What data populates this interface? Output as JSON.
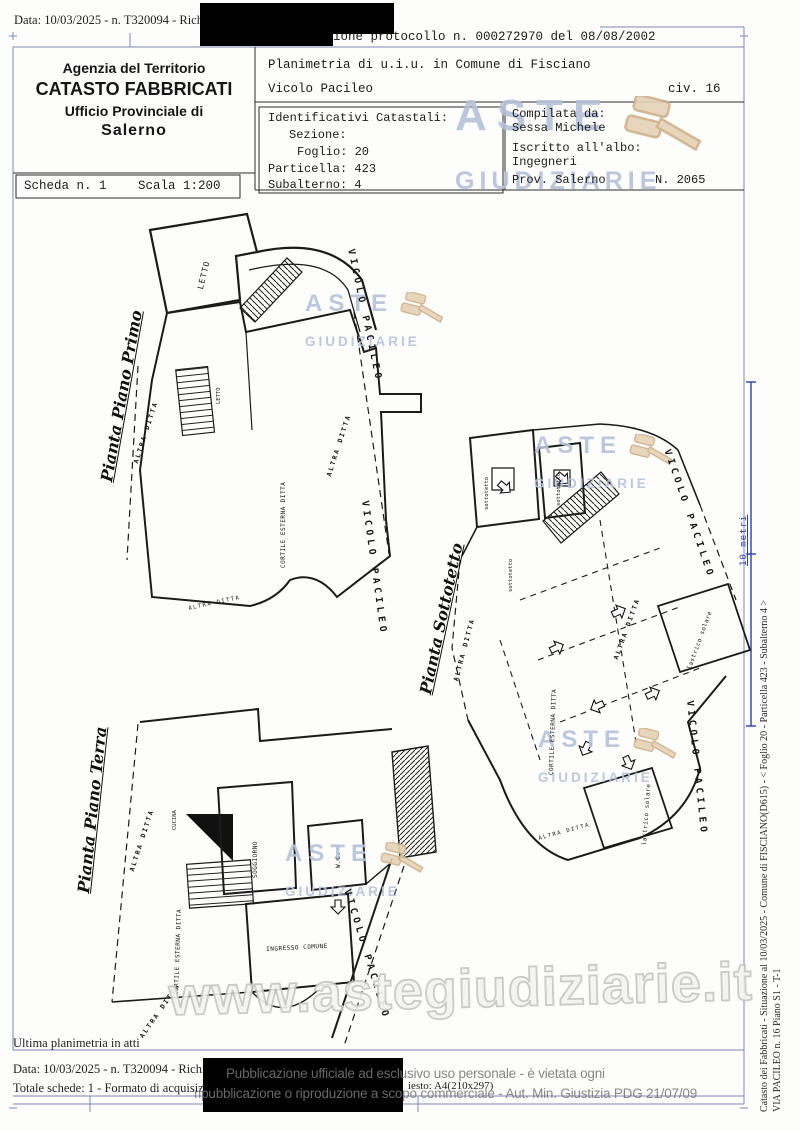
{
  "top": {
    "data_line": "Data: 10/03/2025 - n. T320094 - Richiedent",
    "protocol_line": "ione protocollo n. 000272970 del 08/08/2002"
  },
  "header": {
    "agency_line1": "Agenzia del Territorio",
    "agency_line2": "CATASTO FABBRICATI",
    "agency_line3": "Ufficio Provinciale di",
    "agency_line4": "Salerno",
    "planimetria_line": "Planimetria di u.i.u. in Comune di Fisciano",
    "street_name": "Vicolo Pacileo",
    "civic": "civ. 16",
    "identificativi": {
      "title": "Identificativi Catastali:",
      "sezione": "Sezione:",
      "foglio": "Foglio: 20",
      "particella": "Particella: 423",
      "subalterno": "Subalterno: 4"
    },
    "compilata": {
      "label": "Compilata da:",
      "name": "Sessa Michele",
      "albo_label": "Iscritto all'albo:",
      "albo_value": "Ingegneri",
      "prov": "Prov. Salerno",
      "number": "N.  2065"
    },
    "scheda": "Scheda n. 1",
    "scala": "Scala 1:200"
  },
  "plans": {
    "primo_title": "Pianta Piano Primo",
    "terra_title": "Pianta Piano Terra",
    "sottotetto_title": "Pianta Sottotetto",
    "labels": {
      "street": "VICOLO PACILEO",
      "altra_ditta": "ALTRA DITTA",
      "cortile": "CORTILE ESTERNA DITTA",
      "letto": "LETTO",
      "sottotetto": "sottotetto",
      "lastrico": "lastrico solare",
      "cucina": "CUCINA",
      "soggiorno": "SOGGIORNO",
      "wc": "W.C.",
      "ingresso": "INGRESSO COMUNE"
    }
  },
  "watermark": {
    "aste": "ASTE",
    "giudiziarie": "GIUDIZIARIE",
    "url": "www.astegiudiziarie.it"
  },
  "margin": {
    "line1": "Catasto dei Fabbricati - Situazione al 10/03/2025 - Comune di FISCIANO(D615) - < Foglio 20 - Particella 423 - Subalterno 4 >",
    "line2": "VIA PACILEO n. 16 Piano S1 - T-1",
    "scale_label": "10 metri"
  },
  "footer": {
    "ultima": "Ultima planimetria in atti",
    "data_line": "Data: 10/03/2025 - n. T320094 - Richiedent",
    "totale_line": "Totale schede: 1 - Formato di acquisizione:",
    "formato_tail": "iesto: A4(210x297)",
    "overlay_line1": "Pubblicazione ufficiale ad esclusivo uso personale - è vietata ogni",
    "overlay_line2": "ripubblicazione o riproduzione a scopo commerciale - Aut. Min. Giustizia PDG 21/07/09"
  }
}
